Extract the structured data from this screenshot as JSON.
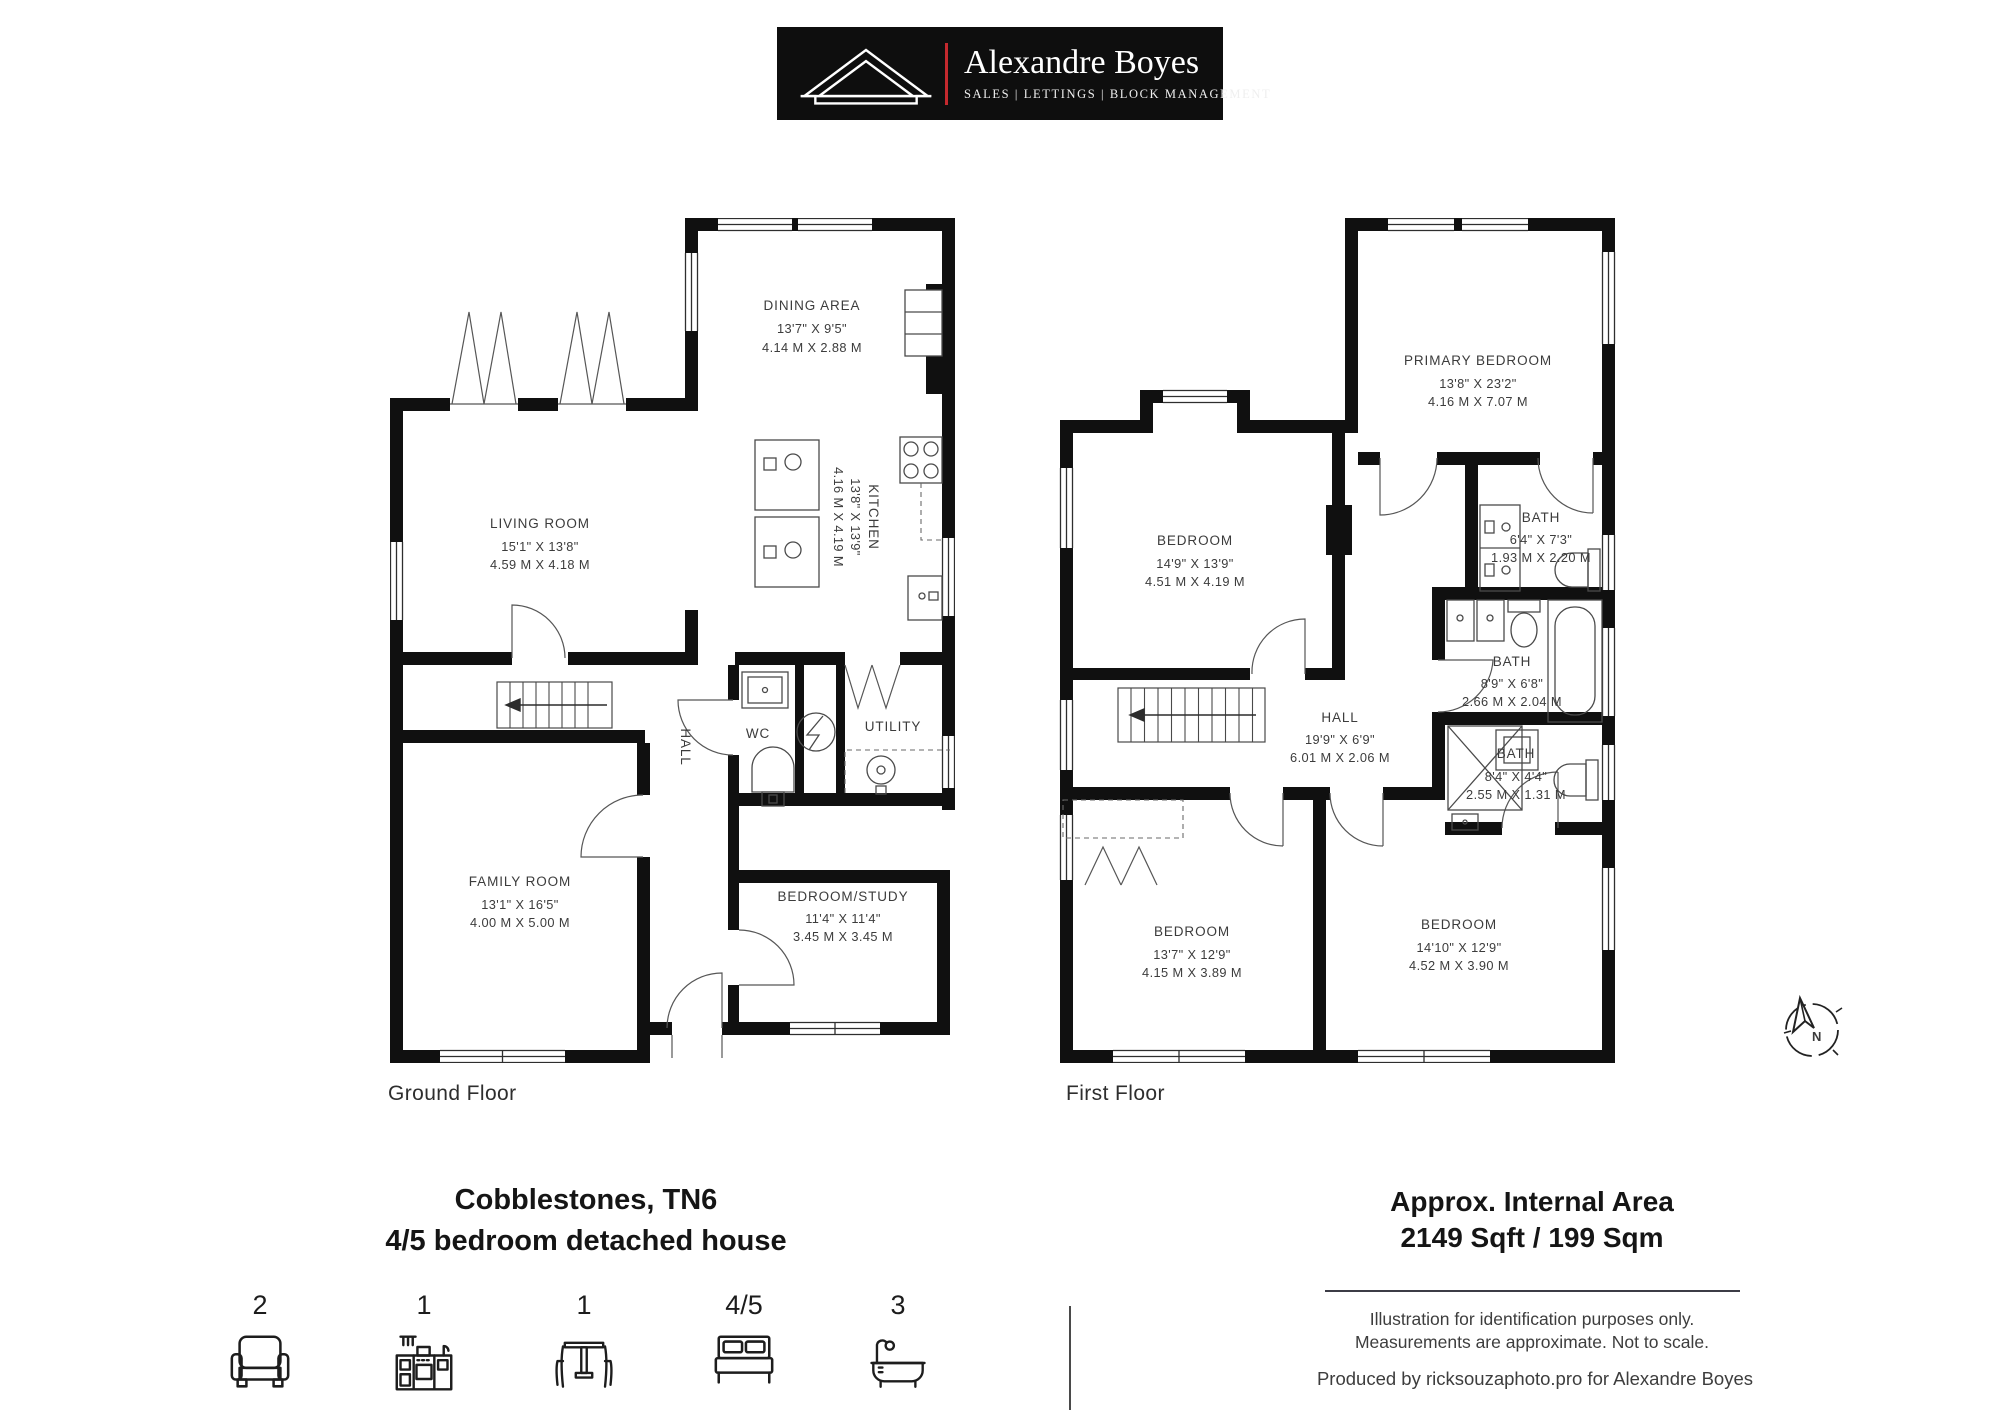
{
  "logo": {
    "brand": "Alexandre Boyes",
    "tagline": "SALES  |  LETTINGS  |  BLOCK MANAGEMENT",
    "bg_color": "#0e0e0e",
    "accent_color": "#c4292e"
  },
  "floors": {
    "ground": {
      "label": "Ground Floor",
      "rooms": [
        {
          "name": "DINING AREA",
          "imperial": "13'7\" X 9'5\"",
          "metric": "4.14 M X 2.88 M"
        },
        {
          "name": "KITCHEN",
          "imperial": "13'8\" X 13'9\"",
          "metric": "4.16 M X 4.19 M"
        },
        {
          "name": "LIVING ROOM",
          "imperial": "15'1\" X 13'8\"",
          "metric": "4.59 M X 4.18 M"
        },
        {
          "name": "WC"
        },
        {
          "name": "UTILITY"
        },
        {
          "name": "HALL"
        },
        {
          "name": "FAMILY ROOM",
          "imperial": "13'1\" X 16'5\"",
          "metric": "4.00 M X 5.00 M"
        },
        {
          "name": "BEDROOM/STUDY",
          "imperial": "11'4\" X 11'4\"",
          "metric": "3.45 M X 3.45 M"
        }
      ]
    },
    "first": {
      "label": "First Floor",
      "rooms": [
        {
          "name": "PRIMARY BEDROOM",
          "imperial": "13'8\" X 23'2\"",
          "metric": "4.16 M X 7.07 M"
        },
        {
          "name": "BEDROOM",
          "imperial": "14'9\" X 13'9\"",
          "metric": "4.51 M X 4.19 M"
        },
        {
          "name": "BATH",
          "imperial": "6'4\" X 7'3\"",
          "metric": "1.93 M X 2.20 M"
        },
        {
          "name": "BATH",
          "imperial": "8'9\" X 6'8\"",
          "metric": "2.66 M X 2.04 M"
        },
        {
          "name": "HALL",
          "imperial": "19'9\" X 6'9\"",
          "metric": "6.01 M X 2.06 M"
        },
        {
          "name": "BATH",
          "imperial": "8'4\" X 4'4\"",
          "metric": "2.55 M X 1.31 M"
        },
        {
          "name": "BEDROOM",
          "imperial": "13'7\" X 12'9\"",
          "metric": "4.15 M X 3.89 M"
        },
        {
          "name": "BEDROOM",
          "imperial": "14'10\" X 12'9\"",
          "metric": "4.52 M X 3.90 M"
        }
      ]
    }
  },
  "summary": {
    "title_line1": "Cobblestones, TN6",
    "title_line2": "4/5 bedroom detached house",
    "area_line1": "Approx. Internal Area",
    "area_line2": "2149 Sqft / 199 Sqm",
    "disclaimer_line1": "Illustration for identification purposes only.",
    "disclaimer_line2": "Measurements are approximate. Not to scale.",
    "credit": "Produced by ricksouzaphoto.pro for Alexandre Boyes",
    "compass_label": "N",
    "counts": [
      {
        "icon": "sofa-icon",
        "value": "2"
      },
      {
        "icon": "kitchen-icon",
        "value": "1"
      },
      {
        "icon": "dining-icon",
        "value": "1"
      },
      {
        "icon": "bed-icon",
        "value": "4/5"
      },
      {
        "icon": "bath-icon",
        "value": "3"
      }
    ]
  }
}
